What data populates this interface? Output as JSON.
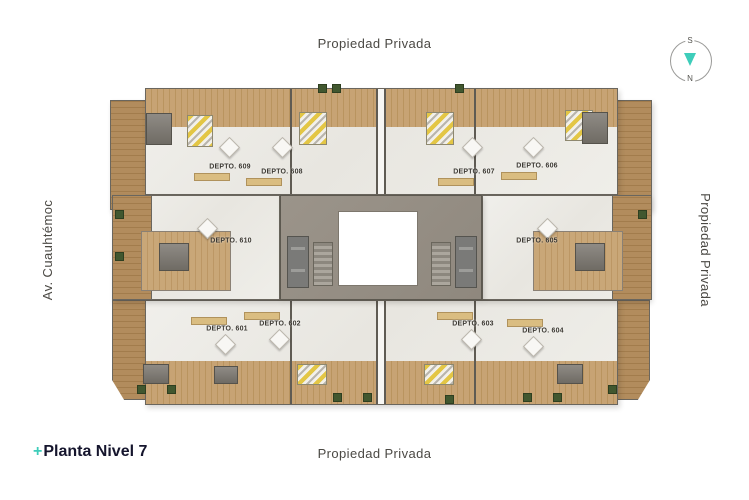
{
  "labels": {
    "top": "Propiedad Privada",
    "right": "Propiedad Privada",
    "left": "Av. Cuauhtémoc",
    "bottom": "Propiedad Privada"
  },
  "footer": {
    "plus": "+",
    "title": "Planta Nivel 7"
  },
  "compass": {
    "south": "S",
    "north": "N"
  },
  "colors": {
    "accent_teal": "#3ECDBA",
    "title_color": "#15152D",
    "street_label_gray": "#4B4944",
    "wood": "#C2A070",
    "deck_wood": "#B28C5D",
    "marble": "#ECEAE4",
    "concrete_core": "#968F85",
    "bed_yellow": "#E3C645",
    "planter_green": "#41572F"
  },
  "plan": {
    "units": [
      {
        "id": "609",
        "label": "DEPTO. 609"
      },
      {
        "id": "608",
        "label": "DEPTO. 608"
      },
      {
        "id": "607",
        "label": "DEPTO. 607"
      },
      {
        "id": "606",
        "label": "DEPTO. 606"
      },
      {
        "id": "610",
        "label": "DEPTO. 610"
      },
      {
        "id": "605",
        "label": "DEPTO. 605"
      },
      {
        "id": "601",
        "label": "DEPTO. 601"
      },
      {
        "id": "602",
        "label": "DEPTO. 602"
      },
      {
        "id": "603",
        "label": "DEPTO. 603"
      },
      {
        "id": "604",
        "label": "DEPTO. 604"
      }
    ]
  }
}
